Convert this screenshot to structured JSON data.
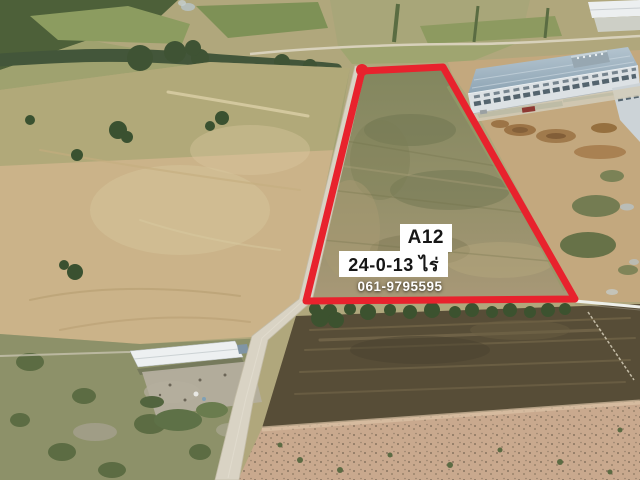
{
  "image": {
    "type": "aerial-drone-photo",
    "subject": "land plot for sale outlined in red next to a factory"
  },
  "annotation": {
    "plot_id": "A12",
    "area": "24-0-13 ไร่",
    "phone": "061-9795595",
    "boundary_color": "#e8222d",
    "label_background": "#ffffff",
    "label_text_color": "#161616",
    "phone_text_color": "#ffffff"
  },
  "scene": {
    "marked_plot": "dry grass field inside red boundary",
    "factory": "long warehouse with blue-grey roof",
    "road": "light concrete road along left edge of plot",
    "left_field": "large plowed tan field",
    "bottom_field": "dark tilled field",
    "shed": "white-roofed farm shed"
  }
}
